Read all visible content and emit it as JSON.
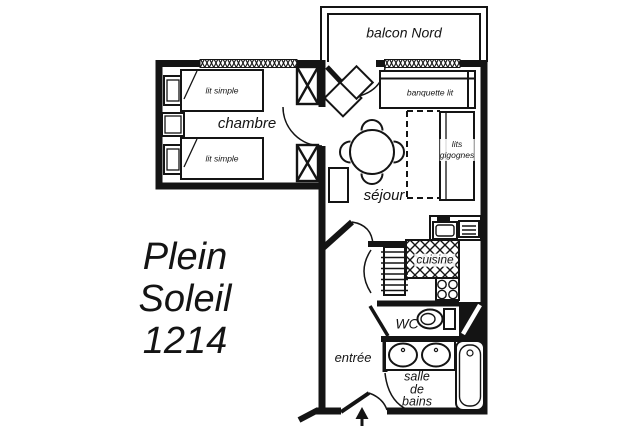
{
  "title": {
    "line1": "Plein",
    "line2": "Soleil",
    "line3": "1214"
  },
  "rooms": {
    "balcony": "balcon Nord",
    "bedroom": "chambre",
    "living_room": "séjour",
    "kitchen": "cuisine",
    "toilet": "WC",
    "entry": "entrée",
    "bathroom": {
      "line1": "salle",
      "line2": "de",
      "line3": "bains"
    }
  },
  "furniture": {
    "single_bed_1": "lit simple",
    "single_bed_2": "lit simple",
    "bench_bed": "banquette lit",
    "nesting_beds": {
      "line1": "lits",
      "line2": "gigognes"
    }
  },
  "icons": {
    "wardrobe": "box-with-x",
    "door": "quarter-arc-swing",
    "window": "hatched-wall-band",
    "entrance_arrow": "up-arrow"
  },
  "colors": {
    "ink": "#141414",
    "paper": "#ffffff"
  }
}
